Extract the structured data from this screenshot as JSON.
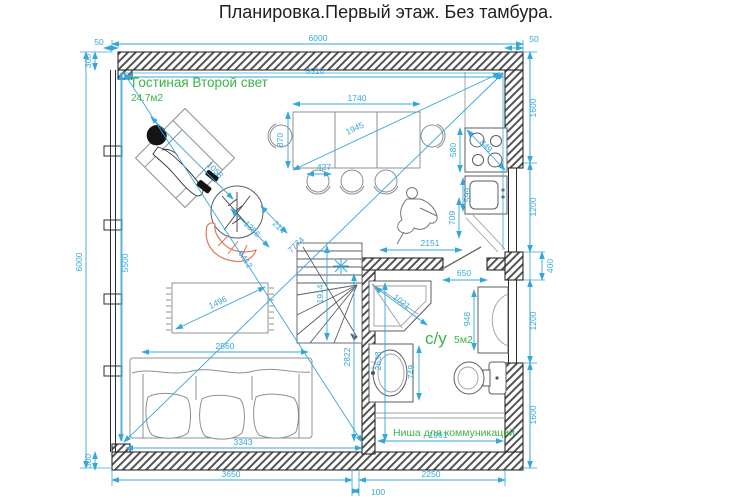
{
  "title": "Планировка.Первый этаж. Без тамбура.",
  "labels": {
    "living_room": "Гостиная Второй свет",
    "living_area": "24.7м2",
    "bathroom": "с/у",
    "bathroom_area": "5м2",
    "niche": "Ниша для коммуникаций"
  },
  "dims": {
    "top_overall": "6000",
    "top_left_offset": "50",
    "top_right_offset": "50",
    "top_inner": "5510",
    "left_overall": "6000",
    "left_inner": "5500",
    "left_top": "300",
    "left_bottom": "300",
    "right_top": "1600",
    "right_upper_window": "1200",
    "right_pier": "400",
    "right_lower_window": "1200",
    "right_bottom": "1600",
    "bottom_left": "3650",
    "bottom_gap": "100",
    "bottom_right": "2250",
    "living_inner_width": "3343",
    "niche_width": "1961",
    "sofa_width": "2560",
    "rug_width": "1496",
    "armchair_diag": "1058",
    "chaise_len": "1356",
    "chaise_off": "214",
    "living_diag_1": "6412",
    "living_diag_2": "7774",
    "stairs_width": "1914",
    "bath_wall_height": "2822",
    "table_width": "1740",
    "table_depth": "870",
    "table_diag": "1945",
    "chair_width": "427",
    "stove_width": "580",
    "stove_diag": "849",
    "sink_width": "599",
    "person_width": "709",
    "kitchen_width": "2151",
    "door_width": "650",
    "shower_diag": "1021",
    "bath_height": "2638",
    "vanity_width": "749",
    "cabinet_height": "948"
  },
  "colors": {
    "dimension": "#36a7db",
    "label_green": "#3bb44a",
    "chaise_orange": "#e0795a",
    "wall": "#2b2b2b"
  }
}
